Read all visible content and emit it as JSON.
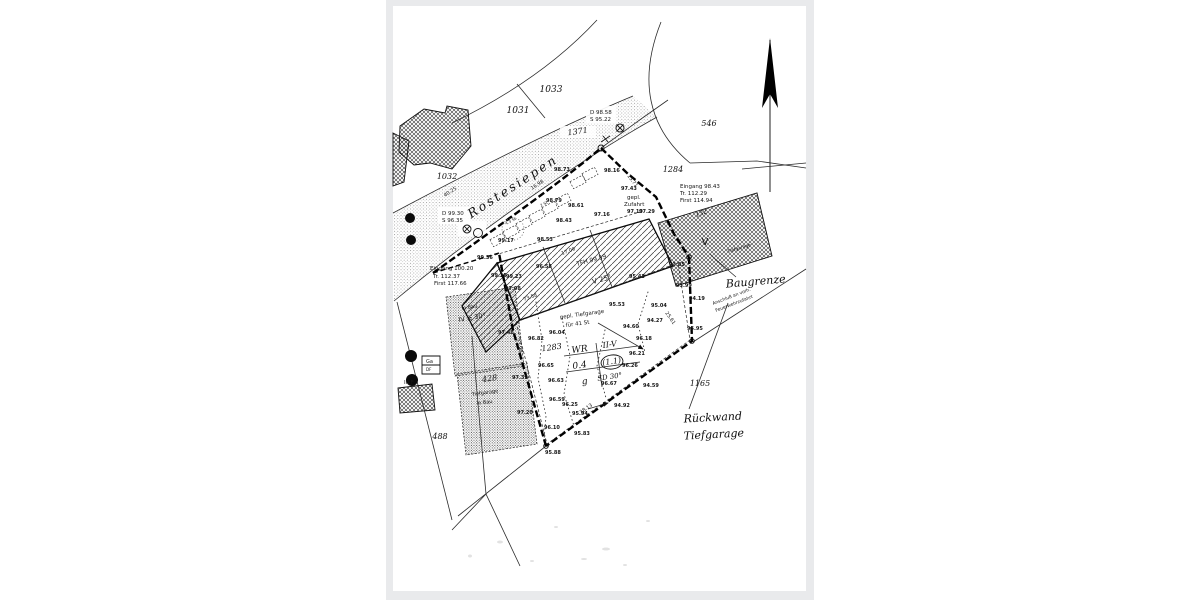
{
  "meta": {
    "kind": "scanned cadastral site plan",
    "colors": {
      "paper": "#ffffff",
      "frame": "#e9eaec",
      "ink": "#1a1a1a"
    }
  },
  "plan": {
    "street_name": "Rostesiepen",
    "zoning_table": {
      "rows": [
        [
          "WR",
          "II-V"
        ],
        [
          "0.4",
          "(1.1)"
        ],
        [
          "g",
          "SD 30°"
        ]
      ]
    },
    "labels": [
      {
        "t": "Rostesiepen",
        "x": 515,
        "y": 190,
        "r": -33,
        "cls": "street",
        "n": "street-name"
      },
      {
        "t": "1033",
        "x": 551,
        "y": 92,
        "cls": "parcel",
        "s": 9,
        "n": "parcel-1033"
      },
      {
        "t": "1031",
        "x": 518,
        "y": 113,
        "cls": "parcel",
        "s": 9,
        "n": "parcel-1031"
      },
      {
        "t": "1032",
        "x": 447,
        "y": 179,
        "cls": "parcel",
        "s": 8,
        "n": "parcel-1032"
      },
      {
        "t": "1371",
        "x": 578,
        "y": 134,
        "r": -8,
        "cls": "parcel",
        "s": 8,
        "n": "parcel-1371"
      },
      {
        "t": "546",
        "x": 709,
        "y": 126,
        "cls": "parcel",
        "s": 8,
        "n": "parcel-546"
      },
      {
        "t": "1284",
        "x": 673,
        "y": 172,
        "cls": "parcel",
        "s": 8,
        "n": "parcel-1284"
      },
      {
        "t": "1283",
        "x": 552,
        "y": 350,
        "r": -8,
        "cls": "parcel",
        "s": 8,
        "n": "parcel-1283"
      },
      {
        "t": "1165",
        "x": 700,
        "y": 386,
        "cls": "parcel",
        "s": 8,
        "n": "parcel-1165"
      },
      {
        "t": "488",
        "x": 440,
        "y": 439,
        "cls": "parcel",
        "s": 8,
        "n": "parcel-488"
      },
      {
        "t": "428",
        "x": 490,
        "y": 381,
        "r": -8,
        "cls": "parcel",
        "s": 8,
        "n": "parcel-428"
      },
      {
        "t": "132",
        "x": 702,
        "y": 215,
        "r": -20,
        "cls": "parcel",
        "s": 6,
        "n": "building-number-132"
      },
      {
        "t": "Baugrenze",
        "x": 756,
        "y": 285,
        "r": -5,
        "cls": "hand",
        "n": "handwritten-baugrenze"
      },
      {
        "t": "Rückwand",
        "x": 713,
        "y": 421,
        "r": -3,
        "cls": "hand",
        "n": "handwritten-rueckwand"
      },
      {
        "t": "Tiefgarage",
        "x": 714,
        "y": 438,
        "r": -3,
        "cls": "hand",
        "n": "handwritten-tiefgarage"
      },
      {
        "t": "WR",
        "x": 580,
        "y": 352,
        "r": -8,
        "cls": "tbl",
        "s": 9,
        "n": "zoning-cell-wr"
      },
      {
        "t": "II-V",
        "x": 610,
        "y": 347,
        "r": -8,
        "cls": "tbl",
        "s": 8,
        "n": "zoning-cell-storeys"
      },
      {
        "t": "0.4",
        "x": 580,
        "y": 368,
        "r": -8,
        "cls": "tbl",
        "s": 9,
        "n": "zoning-cell-grz"
      },
      {
        "t": "(1.1)",
        "x": 612,
        "y": 364,
        "r": -8,
        "cls": "tbl",
        "s": 8,
        "n": "zoning-cell-gfz"
      },
      {
        "t": "g",
        "x": 585,
        "y": 384,
        "r": -8,
        "cls": "tbl",
        "s": 9,
        "n": "zoning-cell-g"
      },
      {
        "t": "SD 30°",
        "x": 610,
        "y": 379,
        "r": -8,
        "cls": "tbl",
        "s": 7,
        "n": "zoning-cell-roof"
      },
      {
        "t": "D 98.58",
        "x": 590,
        "y": 114,
        "cls": "note",
        "n": "note-d9858"
      },
      {
        "t": "S 95.22",
        "x": 590,
        "y": 121,
        "cls": "note",
        "n": "note-s9522"
      },
      {
        "t": "D 99.30",
        "x": 442,
        "y": 215,
        "cls": "note",
        "n": "note-d9930"
      },
      {
        "t": "S 96.35",
        "x": 442,
        "y": 222,
        "cls": "note",
        "n": "note-s9635"
      },
      {
        "t": "Eingang 100.20",
        "x": 430,
        "y": 270,
        "cls": "note",
        "n": "note-eingang-west"
      },
      {
        "t": "Tr. 112.37",
        "x": 433,
        "y": 278,
        "cls": "note",
        "n": "note-traufe-west"
      },
      {
        "t": "First 117.66",
        "x": 434,
        "y": 285,
        "cls": "note",
        "n": "note-first-west"
      },
      {
        "t": "Eingang 98.43",
        "x": 680,
        "y": 188,
        "cls": "note",
        "n": "note-eingang-ost"
      },
      {
        "t": "Tr. 112.29",
        "x": 680,
        "y": 195,
        "cls": "note",
        "n": "note-traufe-ost"
      },
      {
        "t": "First 114.94",
        "x": 680,
        "y": 202,
        "cls": "note",
        "n": "note-first-ost"
      },
      {
        "t": "gepl.",
        "x": 627,
        "y": 199,
        "cls": "note",
        "n": "note-gepl"
      },
      {
        "t": "Zufahrt",
        "x": 624,
        "y": 206,
        "cls": "note",
        "n": "note-zufahrt"
      },
      {
        "t": "97.19",
        "x": 627,
        "y": 213,
        "cls": "elev",
        "n": "spot-9719"
      },
      {
        "t": "gepl. Tiefgarage",
        "x": 560,
        "y": 319,
        "r": -8,
        "cls": "note",
        "n": "note-gepl-tiefgarage"
      },
      {
        "t": "für 41 St",
        "x": 566,
        "y": 327,
        "r": -8,
        "cls": "note",
        "n": "note-41-stellplaetze"
      },
      {
        "t": "TFH 99.59",
        "x": 577,
        "y": 266,
        "r": -15,
        "cls": "note",
        "s": 6,
        "n": "note-tfh"
      },
      {
        "t": "V  25°",
        "x": 593,
        "y": 284,
        "r": -15,
        "cls": "note",
        "s": 7,
        "n": "note-v25"
      },
      {
        "t": "V",
        "x": 705,
        "y": 245,
        "cls": "note",
        "s": 10,
        "a": "middle",
        "n": "note-storeys-v"
      },
      {
        "t": "Tiefgarage",
        "x": 728,
        "y": 253,
        "r": -17,
        "cls": "note",
        "s": 4.5,
        "n": "note-tiefgarage-right"
      },
      {
        "t": "in Bau",
        "x": 462,
        "y": 310,
        "r": -10,
        "cls": "note",
        "s": 5,
        "n": "note-in-bau-1"
      },
      {
        "t": "IV ≥ 30°",
        "x": 459,
        "y": 322,
        "r": -10,
        "cls": "note",
        "s": 6.5,
        "n": "note-iv-30"
      },
      {
        "t": "Tiefgarage",
        "x": 472,
        "y": 396,
        "r": -8,
        "cls": "note",
        "s": 5,
        "n": "note-tiefgarage-428"
      },
      {
        "t": "in Bau",
        "x": 477,
        "y": 405,
        "r": -8,
        "cls": "note",
        "s": 5,
        "n": "note-in-bau-2"
      },
      {
        "t": "Anschluß an vorh.",
        "x": 713,
        "y": 305,
        "r": -21,
        "cls": "note",
        "s": 4.5,
        "n": "note-anschluss"
      },
      {
        "t": "Feuerwehrzufahrt",
        "x": 716,
        "y": 312,
        "r": -21,
        "cls": "note",
        "s": 4.5,
        "n": "note-feuerwehrzufahrt"
      },
      {
        "t": "Ga",
        "x": 426,
        "y": 363,
        "cls": "note",
        "s": 5,
        "n": "note-garage"
      },
      {
        "t": "DF",
        "x": 426,
        "y": 371,
        "cls": "note",
        "s": 4,
        "n": "note-df"
      },
      {
        "t": "III F",
        "x": 404,
        "y": 384,
        "cls": "note",
        "s": 5.5,
        "n": "note-iii-f"
      },
      {
        "t": "4.3 St",
        "x": 506,
        "y": 225,
        "r": -28,
        "cls": "note",
        "s": 4,
        "n": "note-stellplatz-a"
      },
      {
        "t": "2 St",
        "x": 541,
        "y": 207,
        "r": -28,
        "cls": "note",
        "s": 4,
        "n": "note-stellplatz-b"
      },
      {
        "t": "98.73",
        "x": 554,
        "y": 171,
        "cls": "elev",
        "n": "spot-9873"
      },
      {
        "t": "98.16",
        "x": 604,
        "y": 172,
        "cls": "elev",
        "n": "spot-9816"
      },
      {
        "t": "97.43",
        "x": 621,
        "y": 190,
        "cls": "elev",
        "n": "spot-9743"
      },
      {
        "t": "97.29",
        "x": 639,
        "y": 213,
        "cls": "elev",
        "n": "spot-9729"
      },
      {
        "t": "98.79",
        "x": 546,
        "y": 202,
        "cls": "elev",
        "n": "spot-9879"
      },
      {
        "t": "98.61",
        "x": 568,
        "y": 207,
        "cls": "elev",
        "n": "spot-9861"
      },
      {
        "t": "98.43",
        "x": 556,
        "y": 222,
        "cls": "elev",
        "n": "spot-9843"
      },
      {
        "t": "97.16",
        "x": 594,
        "y": 216,
        "cls": "elev",
        "n": "spot-9716"
      },
      {
        "t": "99.17",
        "x": 498,
        "y": 242,
        "cls": "elev",
        "n": "spot-9917"
      },
      {
        "t": "98.53",
        "x": 537,
        "y": 241,
        "cls": "elev",
        "n": "spot-9853"
      },
      {
        "t": "99.36",
        "x": 477,
        "y": 259,
        "cls": "elev",
        "n": "spot-9936"
      },
      {
        "t": "99.25",
        "x": 491,
        "y": 277,
        "cls": "elev",
        "n": "spot-9925"
      },
      {
        "t": "99.23",
        "x": 506,
        "y": 278,
        "cls": "elev",
        "n": "spot-9923"
      },
      {
        "t": "97.08",
        "x": 505,
        "y": 290,
        "cls": "elev",
        "n": "spot-9708"
      },
      {
        "t": "96.58",
        "x": 536,
        "y": 268,
        "cls": "elev",
        "n": "spot-9658"
      },
      {
        "t": "95.43",
        "x": 629,
        "y": 278,
        "cls": "elev",
        "n": "spot-9543"
      },
      {
        "t": "93.85",
        "x": 669,
        "y": 266,
        "cls": "elev",
        "n": "spot-9385"
      },
      {
        "t": "93.99",
        "x": 676,
        "y": 287,
        "cls": "elev",
        "n": "spot-9399"
      },
      {
        "t": "94.19",
        "x": 689,
        "y": 300,
        "cls": "elev",
        "n": "spot-9419"
      },
      {
        "t": "95.95",
        "x": 687,
        "y": 330,
        "cls": "elev",
        "n": "spot-9595"
      },
      {
        "t": "95.04",
        "x": 651,
        "y": 307,
        "cls": "elev",
        "n": "spot-9504"
      },
      {
        "t": "94.27",
        "x": 647,
        "y": 322,
        "cls": "elev",
        "n": "spot-9427"
      },
      {
        "t": "95.53",
        "x": 609,
        "y": 306,
        "cls": "elev",
        "n": "spot-9553"
      },
      {
        "t": "94.60",
        "x": 623,
        "y": 328,
        "cls": "elev",
        "n": "spot-9460"
      },
      {
        "t": "96.18",
        "x": 636,
        "y": 340,
        "cls": "elev",
        "n": "spot-9618"
      },
      {
        "t": "96.21",
        "x": 629,
        "y": 355,
        "cls": "elev",
        "n": "spot-9621"
      },
      {
        "t": "96.26",
        "x": 622,
        "y": 367,
        "cls": "elev",
        "n": "spot-9626"
      },
      {
        "t": "96.67",
        "x": 601,
        "y": 385,
        "cls": "elev",
        "n": "spot-9667"
      },
      {
        "t": "94.59",
        "x": 643,
        "y": 387,
        "cls": "elev",
        "n": "spot-9459"
      },
      {
        "t": "94.92",
        "x": 614,
        "y": 407,
        "cls": "elev",
        "n": "spot-9492"
      },
      {
        "t": "95.94",
        "x": 572,
        "y": 415,
        "cls": "elev",
        "n": "spot-9594"
      },
      {
        "t": "96.25",
        "x": 562,
        "y": 406,
        "cls": "elev",
        "n": "spot-9625"
      },
      {
        "t": "96.59",
        "x": 549,
        "y": 401,
        "cls": "elev",
        "n": "spot-9659"
      },
      {
        "t": "96.10",
        "x": 544,
        "y": 429,
        "cls": "elev",
        "n": "spot-9610"
      },
      {
        "t": "95.83",
        "x": 574,
        "y": 435,
        "cls": "elev",
        "n": "spot-9583"
      },
      {
        "t": "95.88",
        "x": 545,
        "y": 454,
        "cls": "elev",
        "n": "spot-9588"
      },
      {
        "t": "96.65",
        "x": 538,
        "y": 367,
        "cls": "elev",
        "n": "spot-9665"
      },
      {
        "t": "96.63",
        "x": 548,
        "y": 382,
        "cls": "elev",
        "n": "spot-9663"
      },
      {
        "t": "96.82",
        "x": 528,
        "y": 340,
        "cls": "elev",
        "n": "spot-9682"
      },
      {
        "t": "96.04",
        "x": 549,
        "y": 334,
        "cls": "elev",
        "n": "spot-9604"
      },
      {
        "t": "97.48",
        "x": 498,
        "y": 334,
        "cls": "elev",
        "n": "spot-9748"
      },
      {
        "t": "97.39",
        "x": 512,
        "y": 379,
        "cls": "elev",
        "n": "spot-9739"
      },
      {
        "t": "97.20",
        "x": 517,
        "y": 414,
        "cls": "elev",
        "n": "spot-9720"
      },
      {
        "t": "15.71",
        "x": 627,
        "y": 176,
        "r": 52,
        "cls": "dim",
        "n": "dim-1571"
      },
      {
        "t": "25.61",
        "x": 665,
        "y": 313,
        "r": 55,
        "cls": "dim",
        "n": "dim-2561"
      },
      {
        "t": "38.13",
        "x": 581,
        "y": 414,
        "r": -35,
        "cls": "dim",
        "n": "dim-3813"
      },
      {
        "t": "73.58",
        "x": 524,
        "y": 301,
        "r": -20,
        "cls": "dim",
        "n": "dim-7358"
      },
      {
        "t": "23.98",
        "x": 516,
        "y": 339,
        "r": 75,
        "cls": "dim",
        "n": "dim-2398"
      },
      {
        "t": "40.25",
        "x": 445,
        "y": 197,
        "r": -33,
        "cls": "dim",
        "n": "dim-4025"
      },
      {
        "t": "16.98",
        "x": 532,
        "y": 190,
        "r": -33,
        "cls": "dim",
        "n": "dim-1698"
      },
      {
        "t": "17.09",
        "x": 562,
        "y": 255,
        "r": -20,
        "cls": "dim",
        "n": "dim-1709"
      }
    ]
  }
}
